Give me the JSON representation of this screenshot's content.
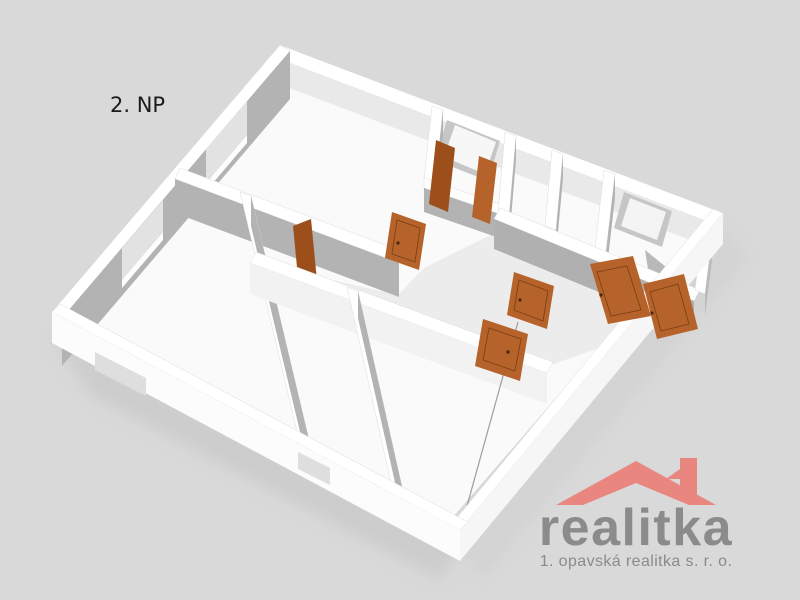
{
  "scene": {
    "background_color": "#d9d9d9",
    "type": "3d-floor-plan-render"
  },
  "floor_label": "2. NP",
  "plan": {
    "wall_color": "#ffffff",
    "wall_shadow_color": "#b3b3b3",
    "wall_light_face_color": "#f2f2f2",
    "floor_color": "#fafafa",
    "hall_floor_color": "#e9e9e9",
    "door_color": "#b5632a",
    "door_dark_color": "#9c4f1a",
    "door_edge_color": "#7a3d12",
    "window_color": "#e2e2e2",
    "window_recess_color": "#c6c6c6"
  },
  "logo": {
    "name": "realitka",
    "tagline": "1. opavská realitka s. r. o.",
    "roof_color": "#e9867f",
    "text_color": "#8b8b8b"
  }
}
